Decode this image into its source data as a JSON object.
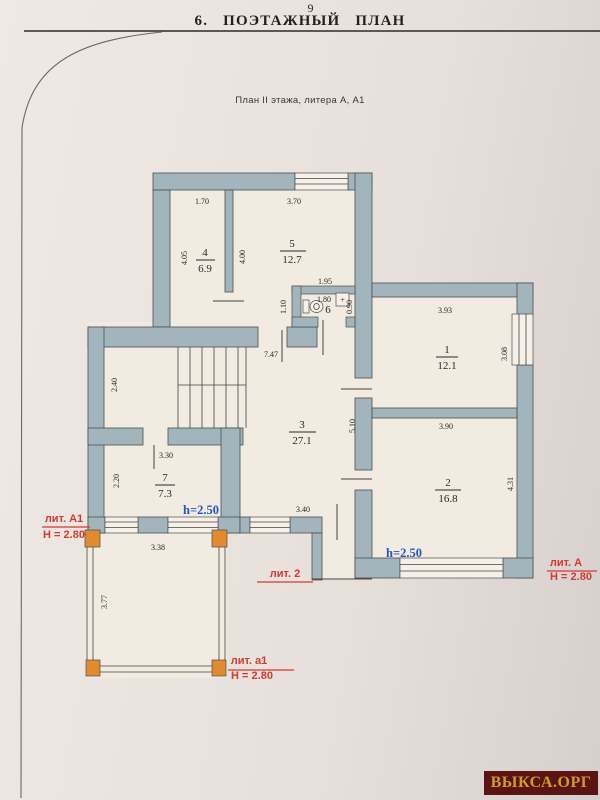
{
  "page": {
    "number": "9",
    "title": "6. ПОЭТАЖНЫЙ ПЛАН",
    "subtitle": "План II этажа, литера А, А1",
    "watermark": "ВЫКСА.ОРГ"
  },
  "colors": {
    "wall": "#a2b5bd",
    "room": "#f1ebe2",
    "window": "#f6f0e8",
    "paper": "#e9e2dd",
    "red": "#d13a32",
    "blue": "#2454bd",
    "orange": "#e28b2e",
    "watermark_bg": "#5a1414",
    "watermark_gold": "#cf9a30"
  },
  "plan": {
    "rooms": {
      "r1": {
        "number": "1",
        "area": "12.1"
      },
      "r2": {
        "number": "2",
        "area": "16.8"
      },
      "r3": {
        "number": "3",
        "area": "27.1"
      },
      "r4": {
        "number": "4",
        "area": "6.9"
      },
      "r5": {
        "number": "5",
        "area": "12.7"
      },
      "r6": {
        "number": "6"
      },
      "r7": {
        "number": "7",
        "area": "7.3"
      }
    },
    "dims": {
      "room4_width": "1.70",
      "room5_width": "3.70",
      "room4_height": "4.05",
      "room5_height": "4.00",
      "wc_outer_width": "1.95",
      "wc_width": "1.80",
      "wc_outer_height": "1.10",
      "wc_height": "0.90",
      "room1_width": "3.93",
      "room1_height": "3.08",
      "hall_width": "7.47",
      "stairhall_height": "2.40",
      "room3_height": "5.10",
      "room3_width": "3.40",
      "room2_width": "3.90",
      "room2_height": "4.31",
      "room7_width": "3.30",
      "room7_height": "2.20",
      "porch_width": "3.38",
      "balcony_height": "3.77"
    },
    "ceiling_height_note": "h=2.50",
    "sink_plus": "+",
    "liters": {
      "a1_upper": {
        "label": "лит. А1",
        "height": "Н = 2.80"
      },
      "lit2": {
        "label": "лит. 2"
      },
      "a": {
        "label": "лит. А",
        "height": "Н = 2.80"
      },
      "a1_lower": {
        "label": "лит. а1",
        "height": "Н = 2.80"
      }
    }
  }
}
